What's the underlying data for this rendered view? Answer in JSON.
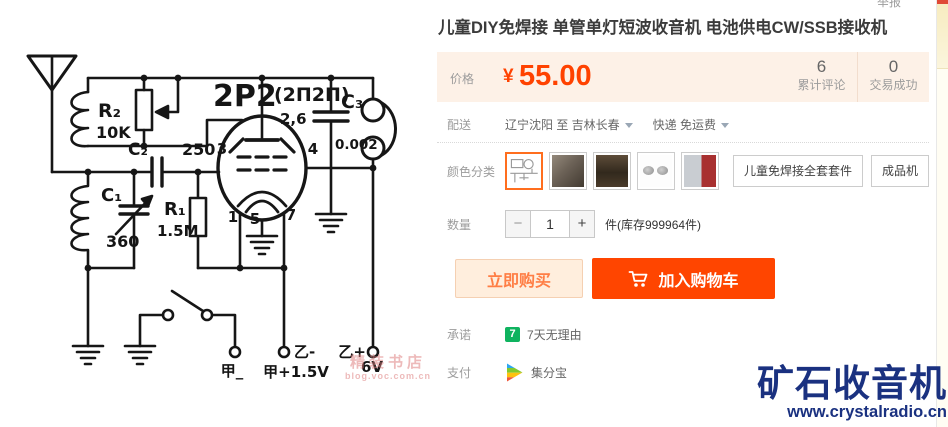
{
  "page": {
    "report_link": "举报"
  },
  "listing": {
    "title": "儿童DIY免焊接 单管单灯短波收音机 电池供电CW/SSB接收机",
    "price": {
      "label": "价格",
      "currency": "¥",
      "amount": "55.00"
    },
    "stats": {
      "reviews_value": "6",
      "reviews_label": "累计评论",
      "deals_value": "0",
      "deals_label": "交易成功"
    },
    "shipping": {
      "label": "配送",
      "route": "辽宁沈阳 至  吉林长春",
      "method": "快递 免运费"
    },
    "sku": {
      "label": "颜色分类",
      "thumbnails": [
        "circuit-diagram",
        "kit-photo",
        "parts-photo",
        "earphone-pair",
        "finished-radio"
      ],
      "selected_index": 0,
      "text_options": [
        "儿童免焊接全套套件",
        "成品机"
      ]
    },
    "quantity": {
      "label": "数量",
      "minus": "−",
      "value": "1",
      "plus": "+",
      "stock_note": "件(库存999964件)"
    },
    "actions": {
      "buy_now": "立即购买",
      "add_to_cart": "加入购物车"
    },
    "promise": {
      "label": "承诺",
      "badge": "7",
      "text": "7天无理由"
    },
    "payment": {
      "label": "支付",
      "text": "集分宝"
    }
  },
  "circuit": {
    "tube": "2P2",
    "tube_alt": "(2П2П)",
    "tube_top_pins": "2,6",
    "pin3": "3",
    "pin4": "4",
    "pin1": "1",
    "pin5": "5",
    "pin7": "7",
    "r2_name": "R₂",
    "r2_value": "10K",
    "c2_name": "C₂",
    "c2_value": "250",
    "c3_name": "C₃",
    "c3_value": "0.002",
    "c1_name": "C₁",
    "c1_value": "360",
    "r1_name": "R₁",
    "r1_value": "1.5M",
    "term_a_minus": "甲_",
    "term_a_plus": "甲+1.5V",
    "term_b_minus": "乙-",
    "term_b_plus": "乙+",
    "term_b_volt": "6V"
  },
  "image_watermark": {
    "text": "精装书店",
    "url": "blog.voc.com.cn"
  },
  "site_watermark": {
    "title": "矿石收音机",
    "url": "www.crystalradio.cn"
  },
  "colors": {
    "price": "#ff4200",
    "cart_button": "#ff4500",
    "selected_border": "#ff6e1e",
    "promise_green": "#0fb35f",
    "logo_blue": "#1a3180"
  }
}
